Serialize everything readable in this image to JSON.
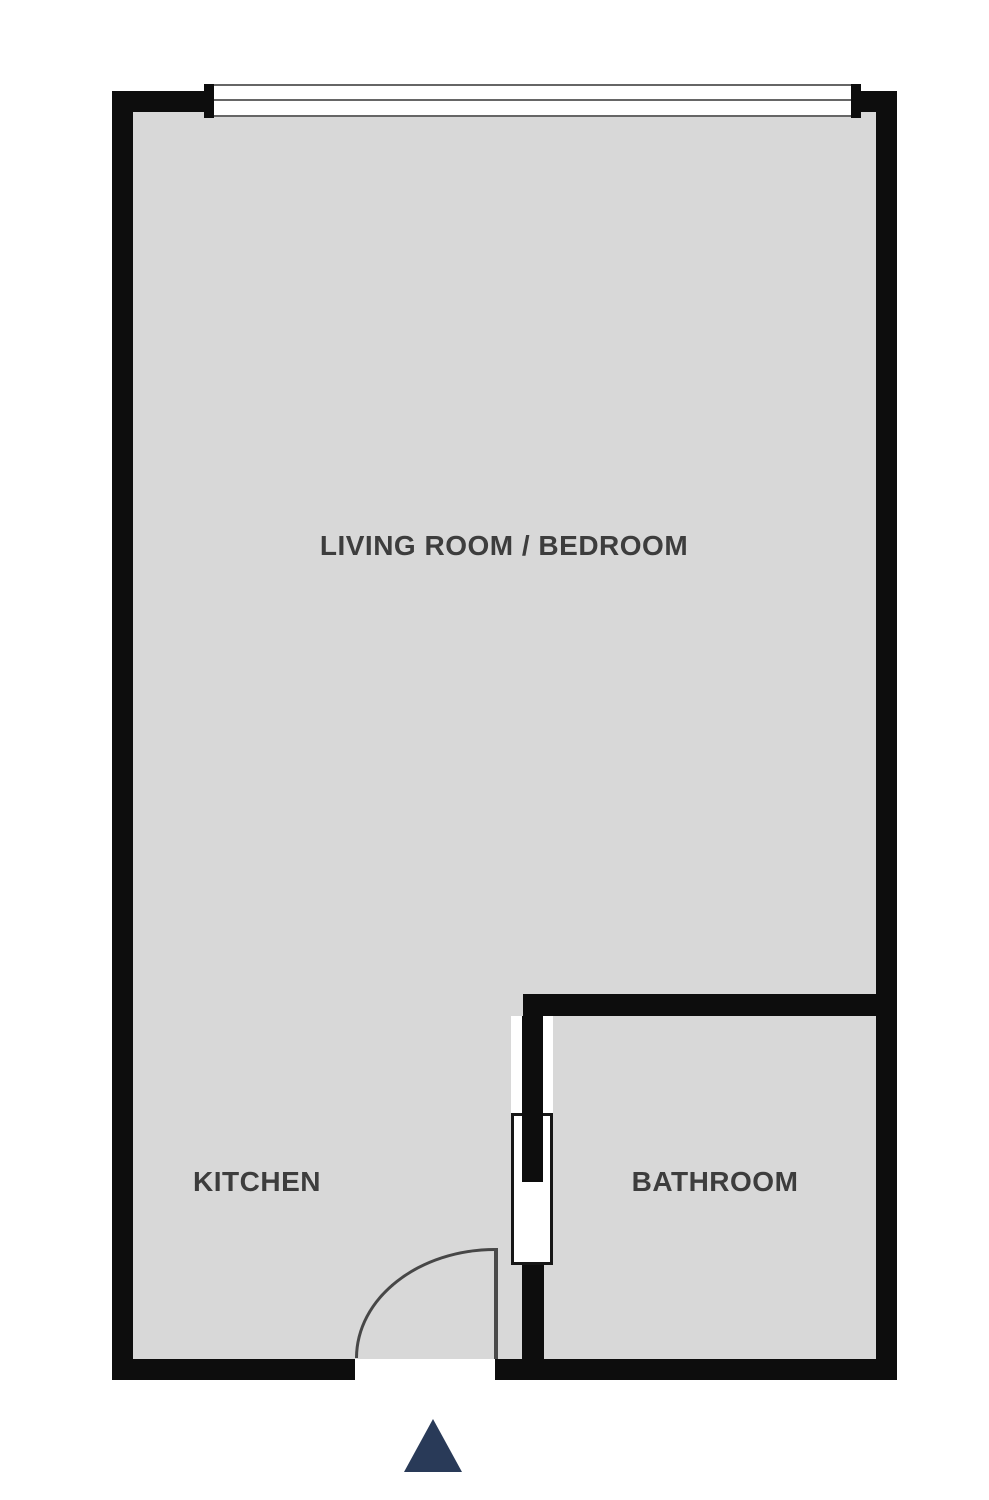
{
  "floorplan": {
    "labels": {
      "living_room": "LIVING ROOM / BEDROOM",
      "kitchen": "KITCHEN",
      "bathroom": "BATHROOM"
    },
    "icons": {
      "window": "window-symbol",
      "entry_door_swing": "door-swing-arc",
      "bathroom_door": "pocket-door-symbol",
      "entrance_marker": "entrance-arrow-icon"
    },
    "colors": {
      "wall": "#0d0d0d",
      "floor": "#d8d8d8",
      "background": "#ffffff",
      "label_text": "#3d3d3d",
      "window_line": "#666666",
      "door_line": "#4a4a4a",
      "entrance_arrow": "#293a58"
    }
  }
}
